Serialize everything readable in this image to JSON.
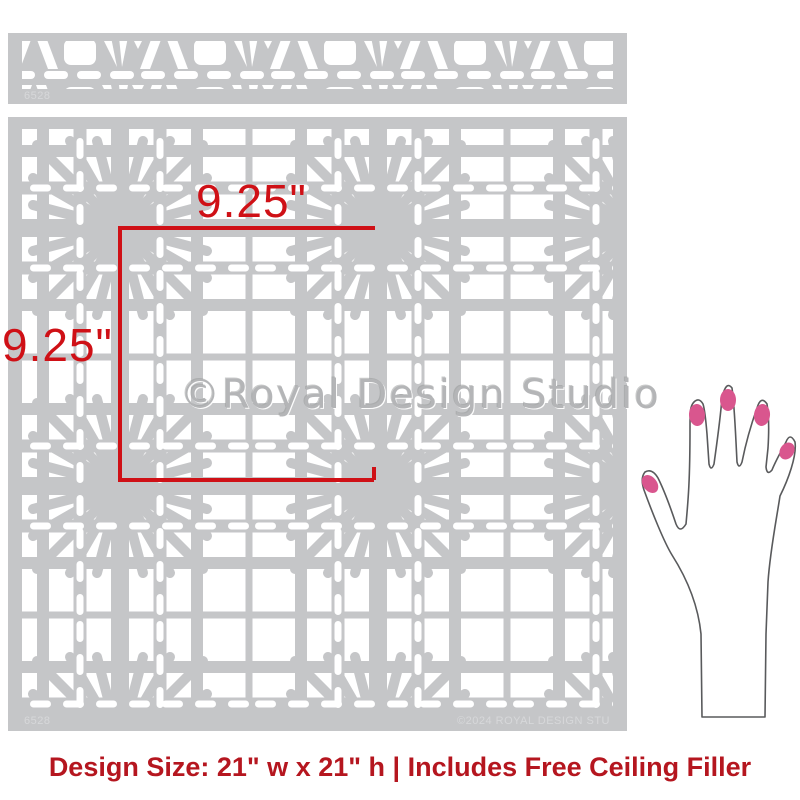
{
  "product_image": {
    "watermark": "©Royal Design Studio",
    "copyright_stamp": "©2024 ROYAL DESIGN STU",
    "product_code": "6528",
    "sheet_color": "#c5c6c8",
    "cutout_color": "#ffffff"
  },
  "dimension_annotations": {
    "width_label": "9.25\"",
    "height_label": "9.25\"",
    "line_color": "#cf1016"
  },
  "caption": {
    "text": "Design Size: 21\" w x 21\" h  |  Includes Free Ceiling Filler",
    "color": "#b5161f"
  },
  "hand_illustration": {
    "meaning": "hand shown for scale",
    "nail_color": "#d9568e",
    "outline_color": "#595a5c"
  }
}
